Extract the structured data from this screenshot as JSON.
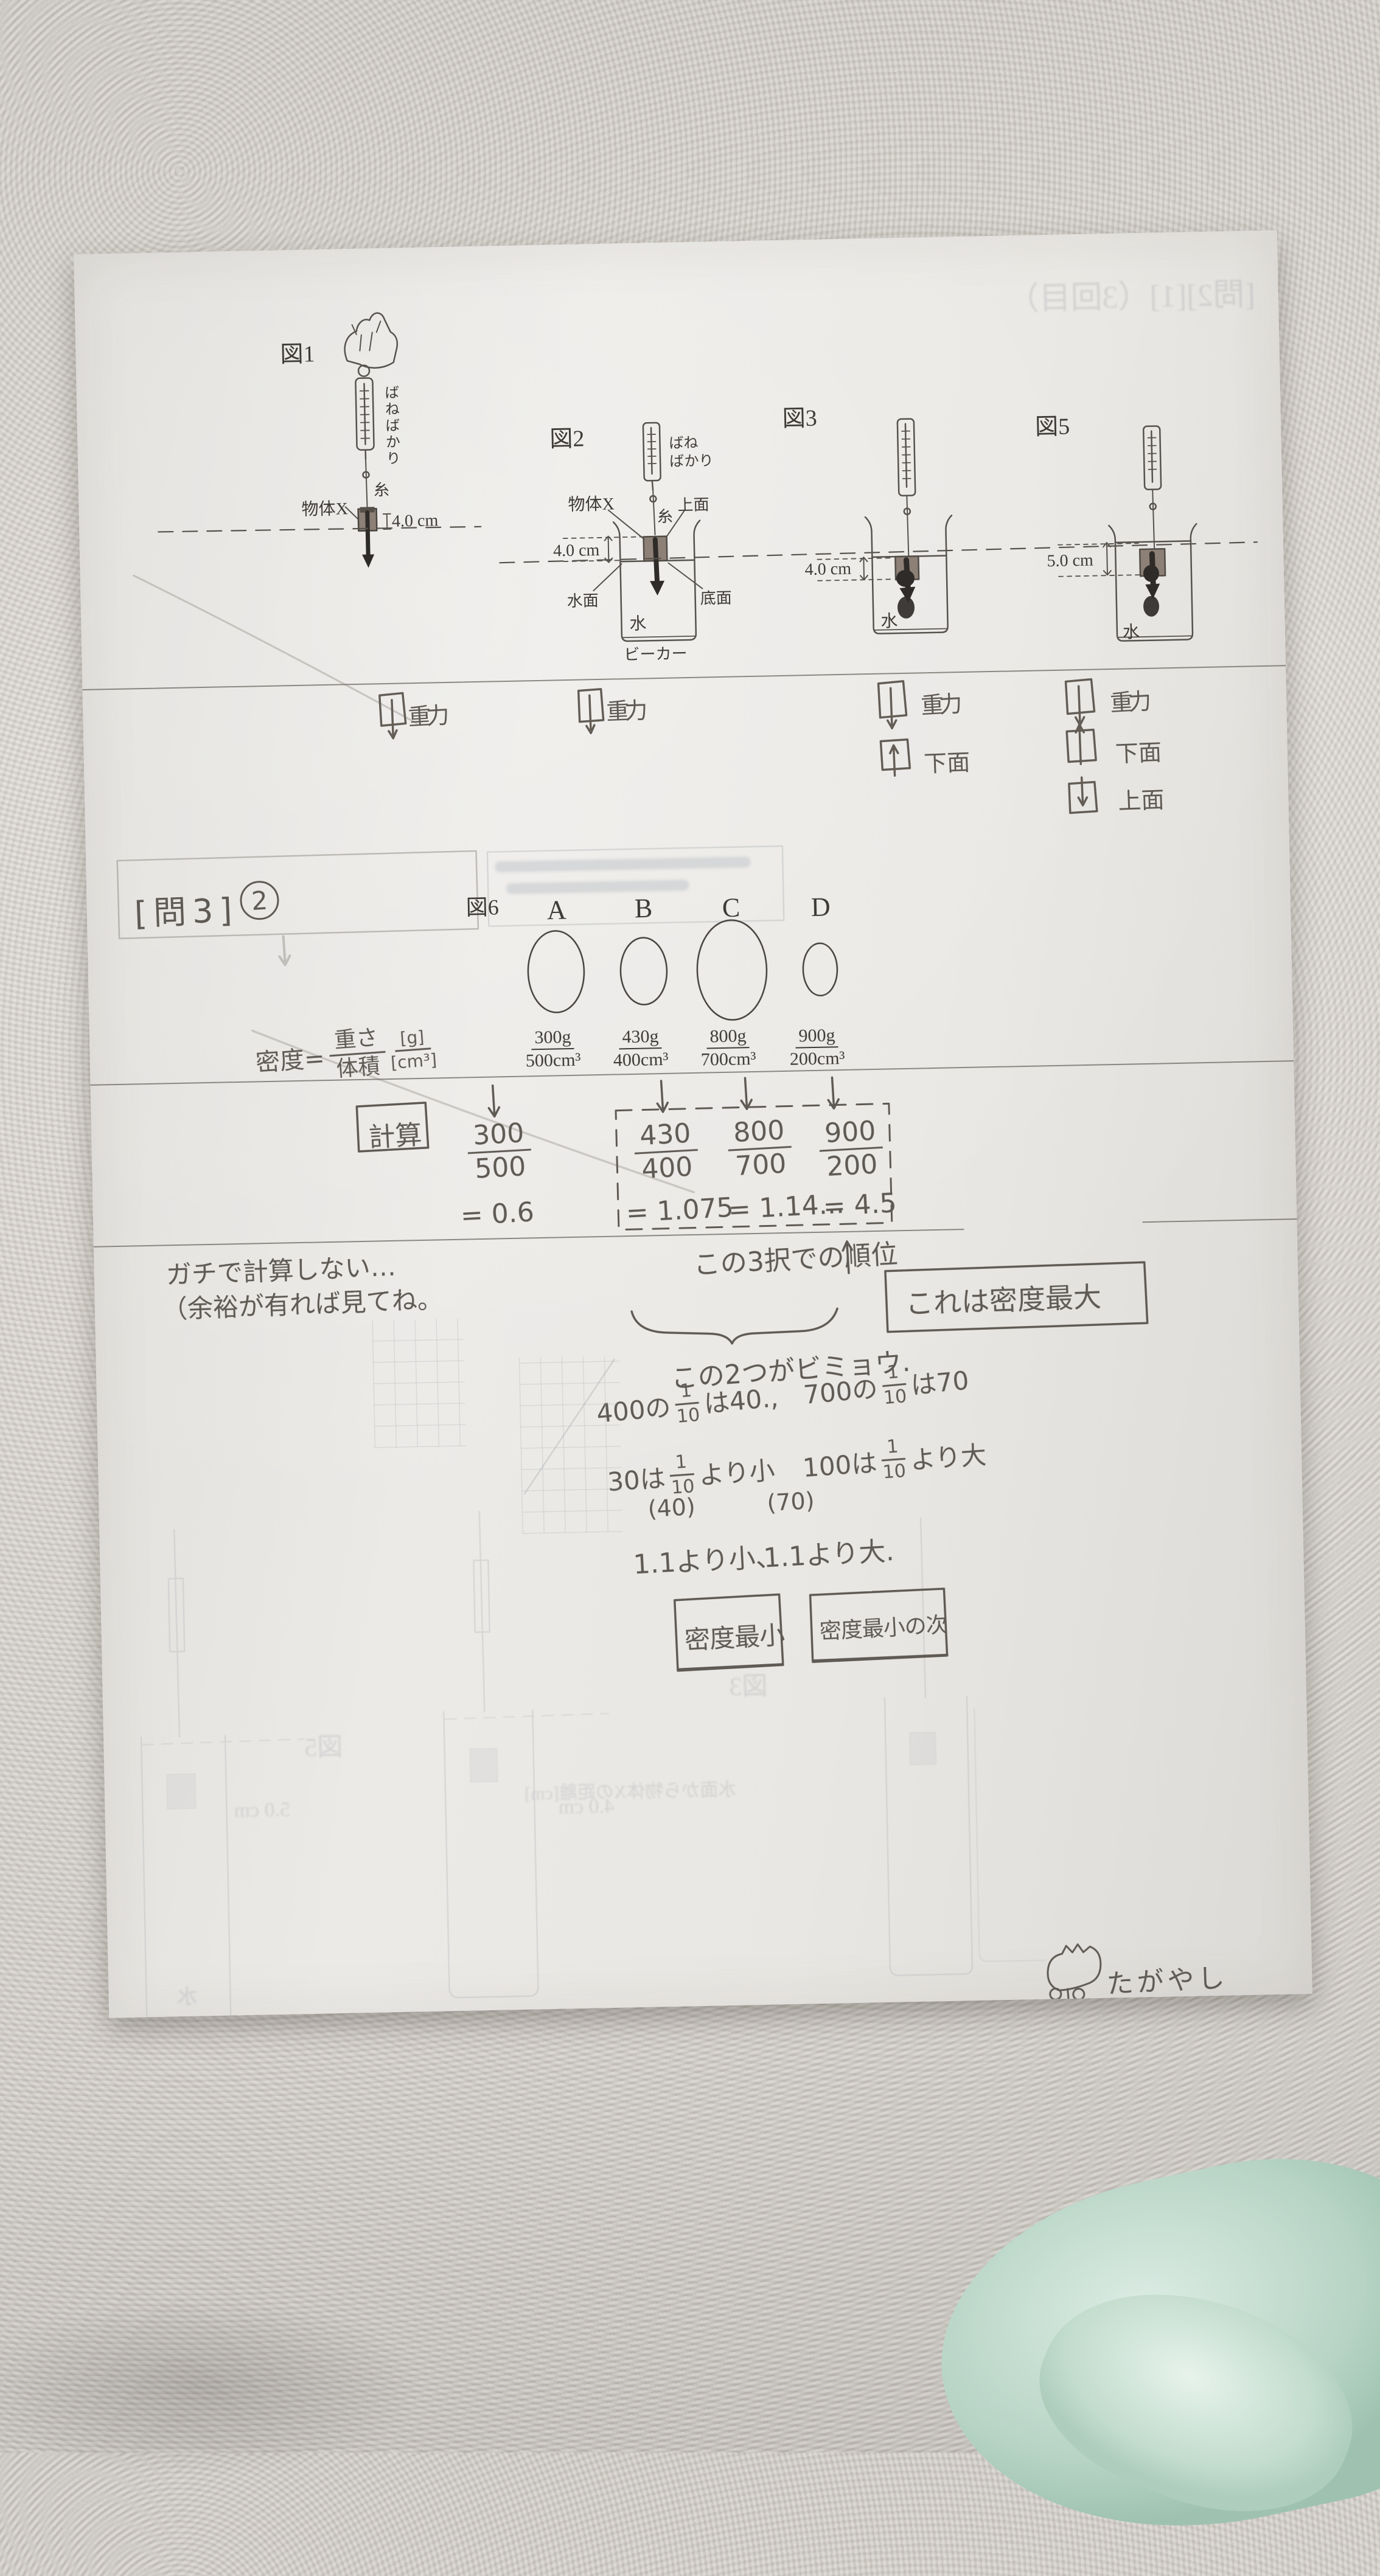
{
  "photo": {
    "paper_color": "#eae8e5",
    "towel_color": "#d6d2cb",
    "mint_towel_color": "#bcd8ca",
    "pencil_color": "#5f5a54",
    "print_color": "#3e3b37",
    "object_fill": "#8d8076"
  },
  "figures": {
    "fig1": {
      "title": "図1",
      "spring_scale": "ばねばかり",
      "string": "糸",
      "object": "物体X",
      "size": "4.0 cm"
    },
    "fig2": {
      "title": "図2",
      "spring_scale_1": "ばね",
      "spring_scale_2": "ばかり",
      "object": "物体X",
      "string": "糸",
      "top_face": "上面",
      "size": "4.0 cm",
      "water_surface": "水面",
      "bottom_face": "底面",
      "water": "水",
      "beaker": "ビーカー"
    },
    "fig3": {
      "title": "図3",
      "size": "4.0 cm",
      "water": "水"
    },
    "fig5": {
      "title": "図5",
      "size": "5.0 cm",
      "water": "水"
    },
    "fig6": {
      "title": "図6"
    }
  },
  "forces": {
    "fig1_gravity": "重力",
    "fig2_gravity": "重力",
    "fig3_gravity": "重力",
    "fig3_bottom": "下面",
    "fig5_gravity": "重力",
    "fig5_bottom": "下面",
    "fig5_top": "上面"
  },
  "problem": {
    "header": "[問3]",
    "number": "2"
  },
  "formula": {
    "label": "密度=",
    "numerator": "重さ",
    "denominator": "体積",
    "unit_num": "[g]",
    "unit_den": "[cm³]"
  },
  "objects": [
    {
      "id": "A",
      "mass": "300g",
      "volume": "500cm³",
      "num": "300",
      "den": "500",
      "result": "= 0.6"
    },
    {
      "id": "B",
      "mass": "430g",
      "volume": "400cm³",
      "num": "430",
      "den": "400",
      "result": "= 1.075"
    },
    {
      "id": "C",
      "mass": "800g",
      "volume": "700cm³",
      "num": "800",
      "den": "700",
      "result": "= 1.14..."
    },
    {
      "id": "D",
      "mass": "900g",
      "volume": "200cm³",
      "num": "900",
      "den": "200",
      "result": "= 4.5"
    }
  ],
  "notes": {
    "calc": "計算",
    "casual1": "ガチで計算しない…",
    "casual2": "（余裕が有れば見てね。",
    "ranking": "この3択での順位",
    "densest": "これは密度最大",
    "subtle": "この2つがビミョウ.",
    "n400": {
      "pre": "400の",
      "fn": "1",
      "fd": "10",
      "post": "は40.,"
    },
    "n700": {
      "pre": "700の",
      "fn": "1",
      "fd": "10",
      "post": "は70"
    },
    "n30": {
      "pre": "30は",
      "fn": "1",
      "fd": "10",
      "post": "より小",
      "paren": "(40)"
    },
    "n100": {
      "pre": "100は",
      "fn": "1",
      "fd": "10",
      "post": "より大",
      "paren": "(70)"
    },
    "lt": "1.1より小、",
    "gt": "1.1より大.",
    "min1": "密度最小",
    "min2": "密度最小の次",
    "sign": "たがやし"
  },
  "ghost": {
    "header": "[問2][1]（3回目）",
    "fig5": "図5",
    "fig3": "図3",
    "dim5": "5.0 cm",
    "dim4": "4.0 cm",
    "water": "水",
    "axis": "水面から物体Xの距離[cm]"
  }
}
